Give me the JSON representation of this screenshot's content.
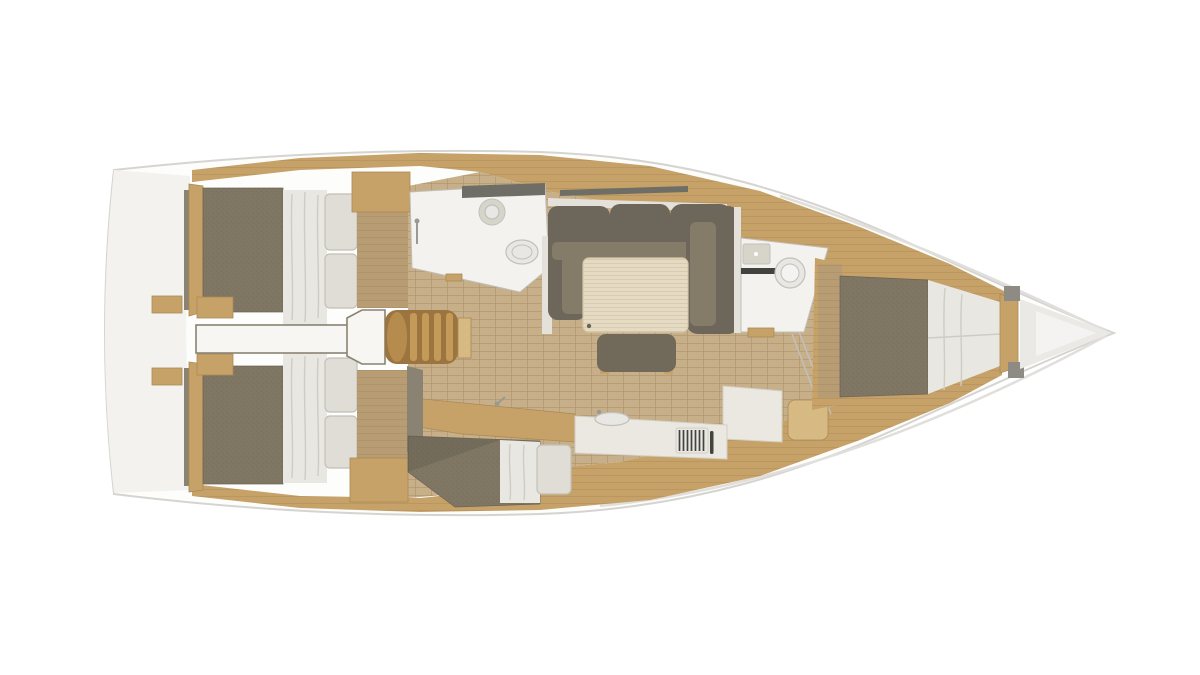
{
  "scene": {
    "kind": "sailboat-interior-floor-plan-render",
    "view": "top-down",
    "bow_direction": "right",
    "background": "#ffffff"
  },
  "colors": {
    "hull": "#fdfdfc",
    "hullStroke": "#d6d4d0",
    "transom": "#f3f2ee",
    "shadow": "#e0dfdb",
    "wood": "#c6a269",
    "woodDark": "#a5824c",
    "woodLight": "#d7ba83",
    "woodLine": "#ab8a54",
    "floor": "#c7af89",
    "floorDark": "#b89c74",
    "floorLine": "#a98e66",
    "mattress": "#7f7763",
    "mattressDark": "#6b6353",
    "bedding": "#e8e7e2",
    "beddingFold": "#cfccc4",
    "pillow": "#dfddd6",
    "pillowEdge": "#c3c0b7",
    "sofa": "#6d665a",
    "sofaSeat": "#847c68",
    "table": "#e5dbc4",
    "tableLine": "#d5c8aa",
    "bench": "#716959",
    "roomWhite": "#f3f2ef",
    "fixture": "#e8e7e3",
    "fixtureEdge": "#c1c0ba",
    "fixtureDark": "#d7d4ca",
    "counter": "#eae8e0",
    "counterEdge": "#d2cfc5",
    "grill": "#43433d",
    "darkCounter": "#6e6e66",
    "ladder": "#9b7440",
    "ladderBar": "#c49a58",
    "ladderCap": "#b68c4e",
    "wallOlive": "#8a8273",
    "wallLight": "#e3e1da",
    "grayTrim": "#8d8b83",
    "locker": "#eae9e5",
    "lockerInner": "#f4f3f1",
    "corridor": "#f7f6f3",
    "chrome": "#9a9994"
  },
  "elements": [
    {
      "name": "hull-outline"
    },
    {
      "name": "stern-transom"
    },
    {
      "name": "side-deck-port"
    },
    {
      "name": "side-deck-starboard"
    },
    {
      "name": "cabin-sole-floor"
    },
    {
      "name": "aft-cabin-port-bed"
    },
    {
      "name": "aft-cabin-starboard-bed"
    },
    {
      "name": "stern-corridor"
    },
    {
      "name": "companionway-landing"
    },
    {
      "name": "companionway-steps"
    },
    {
      "name": "aft-head-room"
    },
    {
      "name": "aft-head-sink"
    },
    {
      "name": "aft-head-toilet"
    },
    {
      "name": "salon-sofa"
    },
    {
      "name": "salon-table"
    },
    {
      "name": "salon-bench"
    },
    {
      "name": "wet-bar-counter"
    },
    {
      "name": "galley-counter"
    },
    {
      "name": "galley-sink"
    },
    {
      "name": "galley-stove"
    },
    {
      "name": "quarter-berth"
    },
    {
      "name": "nav-desk"
    },
    {
      "name": "nav-seat"
    },
    {
      "name": "forward-head-room"
    },
    {
      "name": "forward-head-sink"
    },
    {
      "name": "forward-head-toilet"
    },
    {
      "name": "forward-cabin-bed"
    },
    {
      "name": "bow-bulkhead"
    },
    {
      "name": "anchor-locker"
    }
  ]
}
